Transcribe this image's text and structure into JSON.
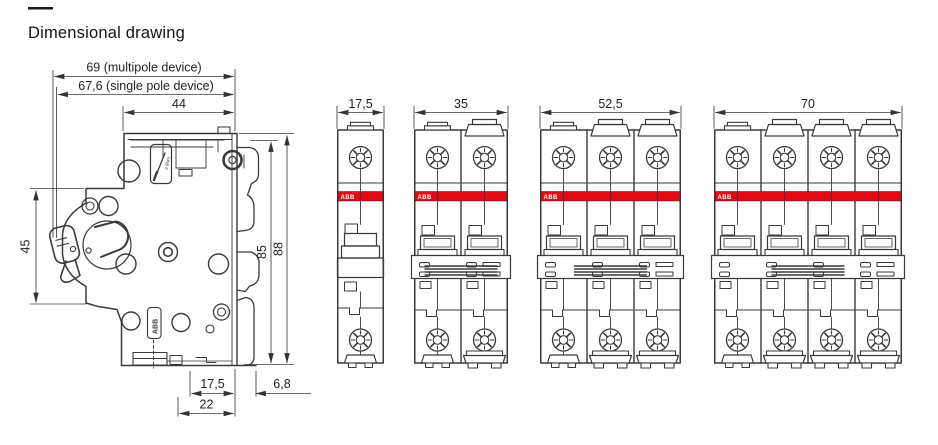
{
  "page": {
    "title_dash": "—",
    "title": "Dimensional drawing"
  },
  "colors": {
    "outline": "#3a3a3a",
    "dimension_line": "#3c3c3c",
    "label_text": "#1f1f1f",
    "abb_red": "#e00b14",
    "band_text": "#ffffff",
    "background": "#ffffff"
  },
  "side_view": {
    "dims": {
      "width_multipole": "69 (multipole device)",
      "width_single_pole": "67,6 (single pole device)",
      "width_upper_body": "44",
      "height_front_section": "45",
      "height_body": "85",
      "height_overall": "88",
      "bottom_inset": "17,5",
      "din_rail_depth": "6,8",
      "bottom_width": "22"
    },
    "labels": {
      "brand_vertical": "ABB",
      "torque": "2.8Nm"
    }
  },
  "front_views": [
    {
      "name": "single-pole",
      "poles": 1,
      "width_label": "17,5",
      "brand": "ABB"
    },
    {
      "name": "two-pole",
      "poles": 2,
      "width_label": "35",
      "brand": "ABB"
    },
    {
      "name": "three-pole",
      "poles": 3,
      "width_label": "52,5",
      "brand": "ABB"
    },
    {
      "name": "four-pole",
      "poles": 4,
      "width_label": "70",
      "brand": "ABB"
    }
  ]
}
